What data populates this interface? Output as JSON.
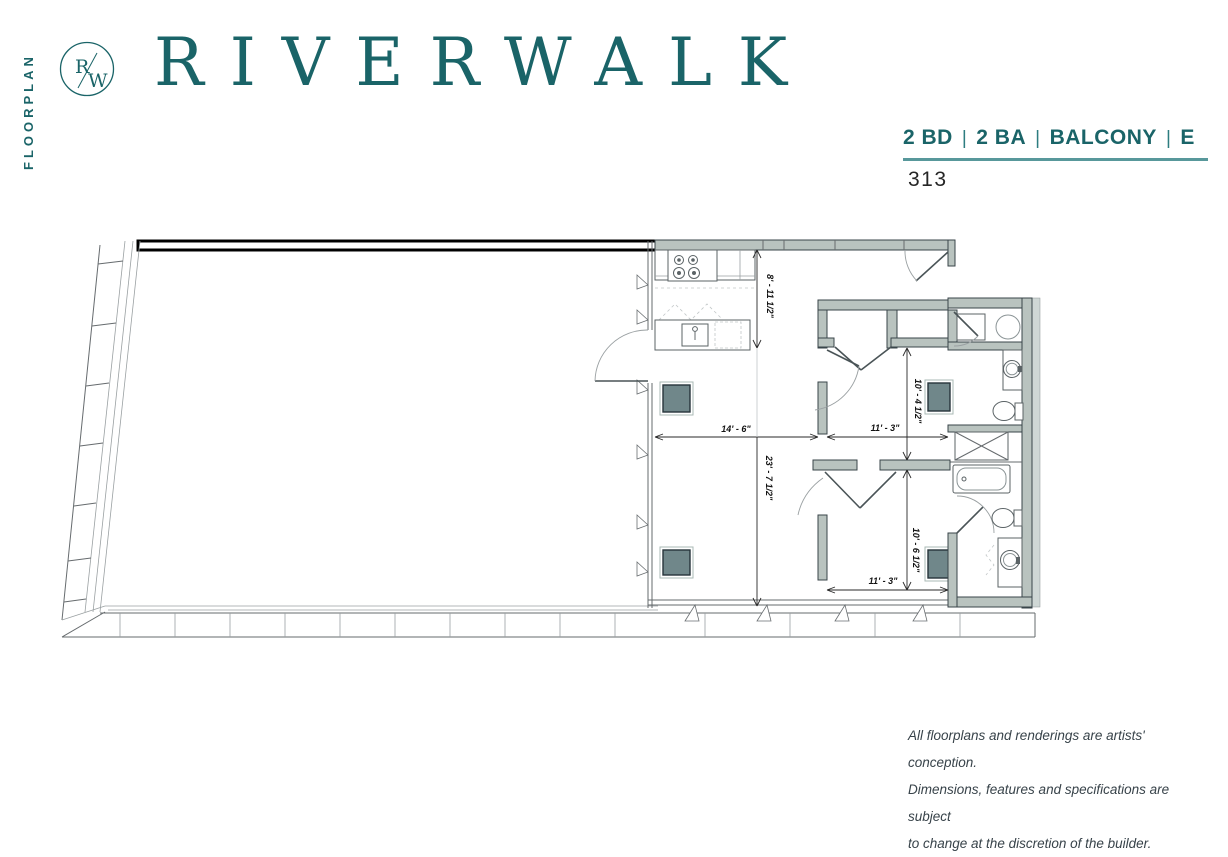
{
  "brand": {
    "floorplan_vertical_label": "FLOORPLAN",
    "logo": {
      "letter_top": "R",
      "letter_bottom": "W"
    },
    "title": "RIVERWALK",
    "accent_color": "#1a6468"
  },
  "header": {
    "specs": [
      {
        "label": "2 BD"
      },
      {
        "label": "2 BA"
      },
      {
        "label": "BALCONY"
      },
      {
        "label": "E"
      }
    ],
    "separator": "|",
    "unit_number": "313"
  },
  "floorplan": {
    "dims": {
      "kitchen_depth": "8' - 11 1/2\"",
      "living_width": "14' - 6\"",
      "living_depth": "23' - 7 1/2\"",
      "bed1_width": "11' - 3\"",
      "bed1_depth": "10' - 4 1/2\"",
      "bed2_width": "11' - 3\"",
      "bed2_depth": "10' - 6 1/2\""
    }
  },
  "footer": {
    "disclaimer_lines": [
      "All floorplans and renderings are artists' conception.",
      "Dimensions, features and specifications are subject",
      "to change at the discretion of the builder."
    ]
  }
}
